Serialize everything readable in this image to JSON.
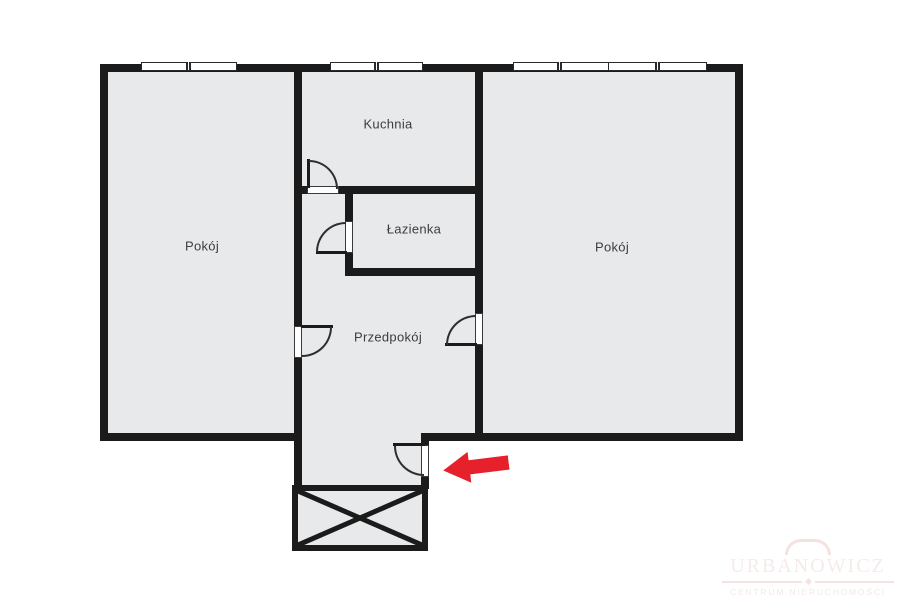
{
  "floorplan": {
    "rooms": [
      {
        "key": "pokoj_left",
        "label": "Pokój"
      },
      {
        "key": "kuchnia",
        "label": "Kuchnia"
      },
      {
        "key": "lazienka",
        "label": "Łazienka"
      },
      {
        "key": "przedpokoj",
        "label": "Przedpokój"
      },
      {
        "key": "pokoj_right",
        "label": "Pokój"
      }
    ],
    "features": {
      "windows_count": 4,
      "doors_count": 5,
      "balcony_marked_with_cross": true,
      "entrance_arrow_direction": "left"
    },
    "colors": {
      "wall": "#1b1b1b",
      "floor_fill": "#e8e9ea",
      "arrow_red": "#e6212b",
      "label_text": "#3d3d3d",
      "watermark_tint": "#f3e2df"
    },
    "watermark": {
      "title": "URBANOWICZ",
      "subtitle": "CENTRUM NIERUCHOMOŚCI"
    }
  }
}
